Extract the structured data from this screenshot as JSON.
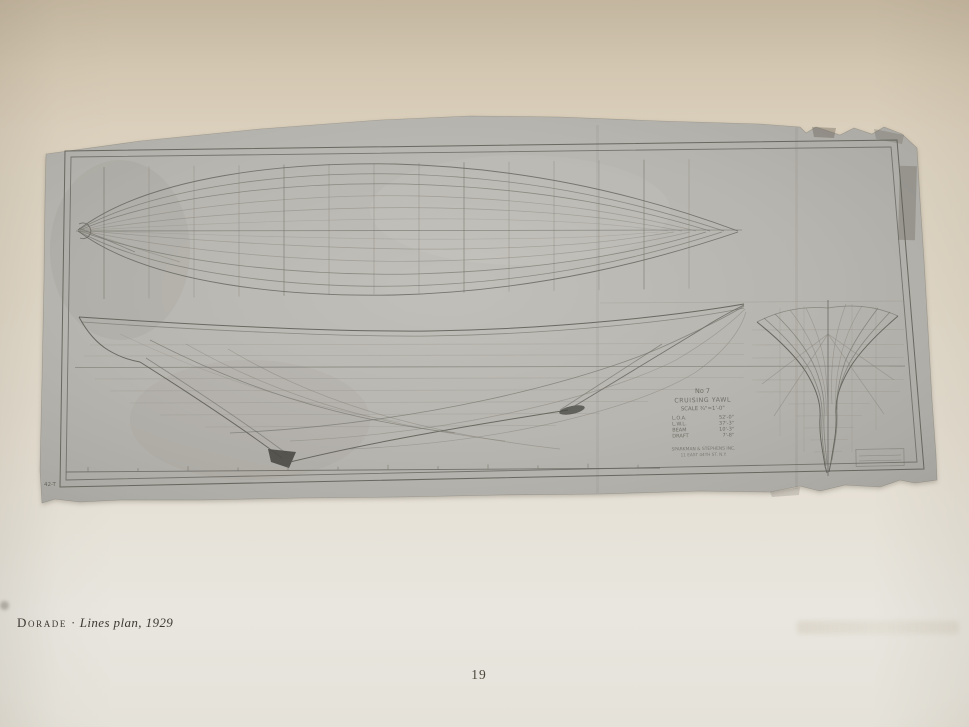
{
  "page": {
    "caption": {
      "vessel": "Dorade",
      "separator": "·",
      "work": "Lines plan, 1929"
    },
    "page_number": "19"
  },
  "sheet": {
    "title_block": {
      "design_no": "No 7",
      "type_line": "CRUISING YAWL",
      "scale_line": "SCALE ¾\"=1'-0\"",
      "specs": [
        {
          "label": "L.O.A.",
          "value": "52'-0\""
        },
        {
          "label": "L.W.L.",
          "value": "37'-3\""
        },
        {
          "label": "BEAM",
          "value": "10'-3\""
        },
        {
          "label": "DRAFT",
          "value": "7'-8\""
        }
      ],
      "firm_line1": "SPARKMAN & STEPHENS INC.",
      "firm_line2": "11 EAST 44TH ST. N.Y."
    },
    "corner_mark": "42-T",
    "colors": {
      "sheet_gray": "#b7b5af",
      "page_cream": "#e2dac9",
      "ink": "#5b5a54",
      "keel_shoe": "#4b4a45"
    }
  }
}
